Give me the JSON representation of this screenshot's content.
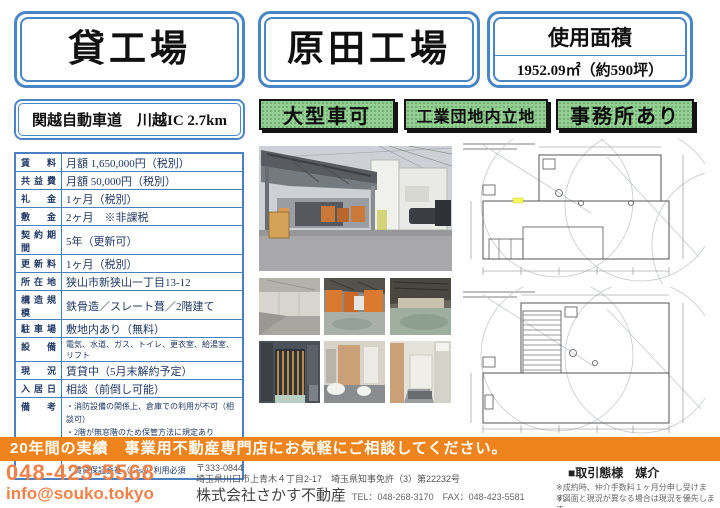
{
  "header": {
    "category": "貸工場",
    "property_name": "原田工場",
    "area_label": "使用面積",
    "area_value": "1952.09㎡（約590坪）",
    "access": "関越自動車道　川越IC 2.7km",
    "badges": [
      "大型車可",
      "工業団地内立地",
      "事務所あり"
    ]
  },
  "spec_table": {
    "rows": [
      {
        "label": "賃料",
        "value": "月額 1,650,000円（税別）"
      },
      {
        "label": "共益費",
        "value": "月額 50,000円（税別）"
      },
      {
        "label": "礼金",
        "value": "1ヶ月（税別）"
      },
      {
        "label": "敷金",
        "value": "2ヶ月　※非課税"
      },
      {
        "label": "契約期間",
        "value": "5年（更新可）"
      },
      {
        "label": "更新料",
        "value": "1ヶ月（税別）"
      },
      {
        "label": "所在地",
        "value": "狭山市新狭山一丁目13-12"
      },
      {
        "label": "構造規模",
        "value": "鉄骨造／スレート葺／2階建て"
      },
      {
        "label": "駐車場",
        "value": "敷地内あり（無料）"
      },
      {
        "label": "設備",
        "value": "電気、水道、ガス、トイレ、更衣室、給湯室、リフト"
      },
      {
        "label": "現況",
        "value": "賃貸中（5月末解約予定）"
      },
      {
        "label": "入居日",
        "value": "相談（前倒し可能）"
      },
      {
        "label": "備考",
        "value": ""
      }
    ],
    "remarks": [
      "・消防設備の関係上、倉庫での利用が不可（相談可）",
      "・2階が無窓階のため保管方法に規定あり",
      "・2階耐荷重 200kg/㎡、リフト耐荷重 1000kg/機",
      "・一部未登記あり",
      "・賃貸保証会社（Casa）利用必須"
    ]
  },
  "photos": [
    "factory-exterior-canopy",
    "interior-empty-room",
    "interior-orange-partitions",
    "warehouse-floor",
    "freight-lift-cage",
    "restroom",
    "hallway"
  ],
  "floor_plans": [
    "first-floor-plan",
    "second-floor-plan"
  ],
  "banner": {
    "text": "20年間の実績　事業用不動産専門店にお気軽にご相談してください。"
  },
  "contact": {
    "phone": "048-423-5568",
    "email": "info@souko.tokyo",
    "postal": "〒333-0844",
    "address_line": "埼玉県川口市上青木４丁目2-17　埼玉県知事免許（3）第22232号",
    "company": "株式会社さかす不動産",
    "tel_fax": "TEL：048-268-3170　FAX：048-423-5581",
    "transaction_type": "■取引態様　媒介",
    "notes": [
      "※成約時、仲介手数料１ヶ月分申し受けます。",
      "※図面と現況が異なる場合は現況を優先します。"
    ]
  },
  "colors": {
    "accent_blue": "#4a86c4",
    "badge_green": "#93ce93",
    "banner_orange": "#f0841c",
    "text_navy": "#1f3864"
  }
}
